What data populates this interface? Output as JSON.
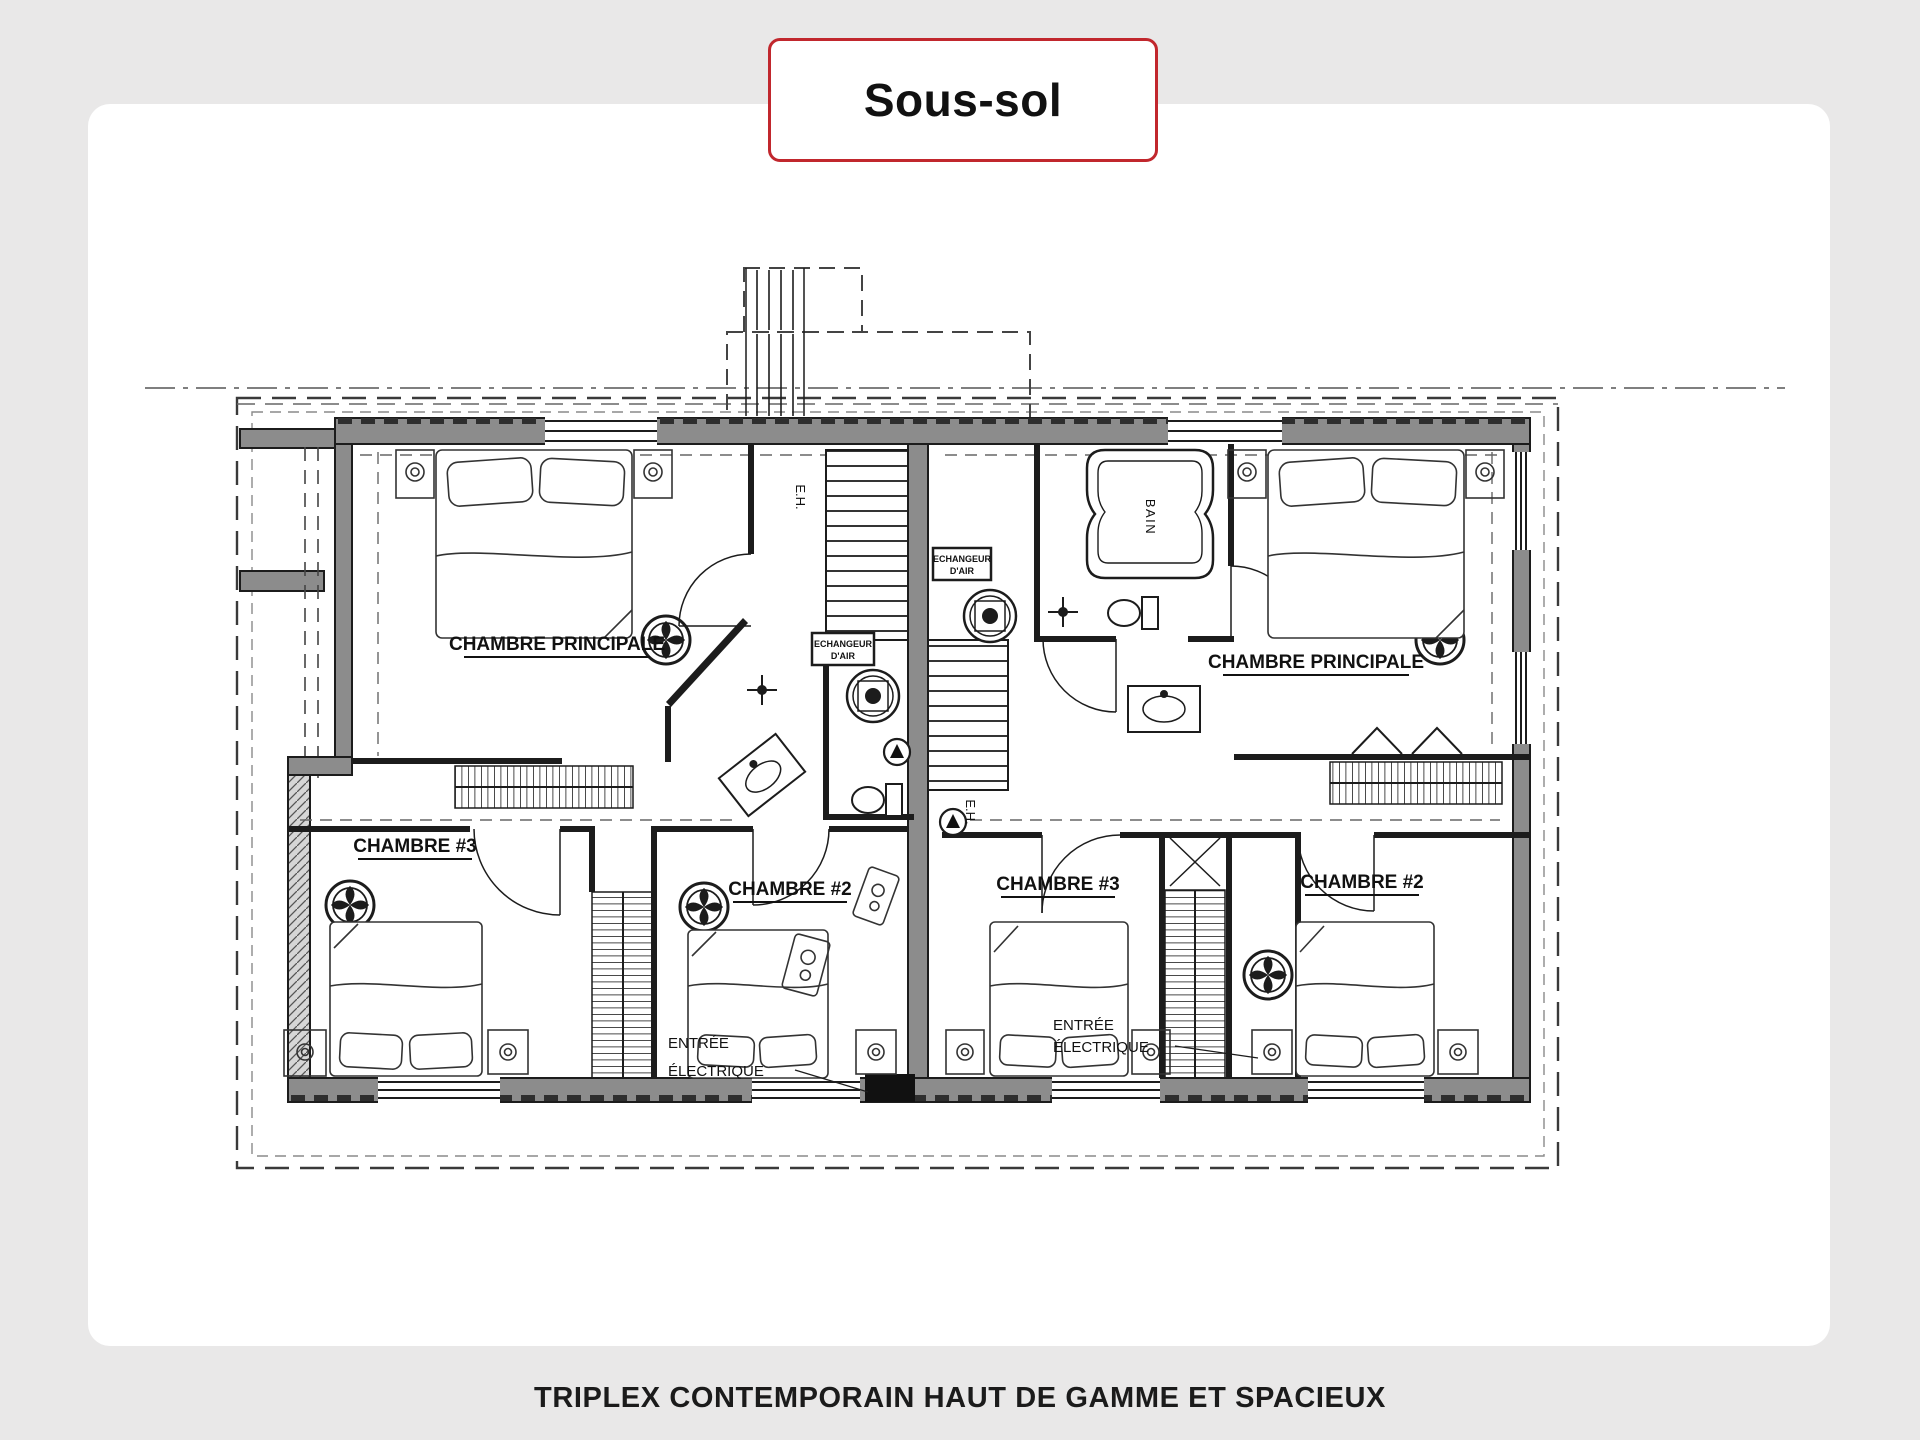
{
  "header": {
    "title": "Sous-sol"
  },
  "footer": {
    "caption": "TRIPLEX CONTEMPORAIN HAUT DE GAMME ET SPACIEUX"
  },
  "colors": {
    "accent": "#c1272d",
    "page_bg": "#e9e8e8",
    "card_bg": "#ffffff",
    "wall": "#8c8c8c",
    "line": "#1c1c1c"
  },
  "floorplan": {
    "left_unit": {
      "master": "CHAMBRE PRINCIPALE",
      "bedroom3": "CHAMBRE #3",
      "bedroom2": "CHAMBRE #2",
      "electrical_1": "ENTRÉE",
      "electrical_2": "ÉLECTRIQUE",
      "air_exchanger_1": "ECHANGEUR",
      "air_exchanger_2": "D'AIR",
      "stair_code": "E.H."
    },
    "right_unit": {
      "master": "CHAMBRE PRINCIPALE",
      "bedroom3": "CHAMBRE #3",
      "bedroom2": "CHAMBRE #2",
      "electrical_1": "ENTRÉE",
      "electrical_2": "ÉLECTRIQUE",
      "air_exchanger_1": "ECHANGEUR",
      "air_exchanger_2": "D'AIR",
      "stair_code": "E.H."
    },
    "bath_label": "BAIN"
  }
}
